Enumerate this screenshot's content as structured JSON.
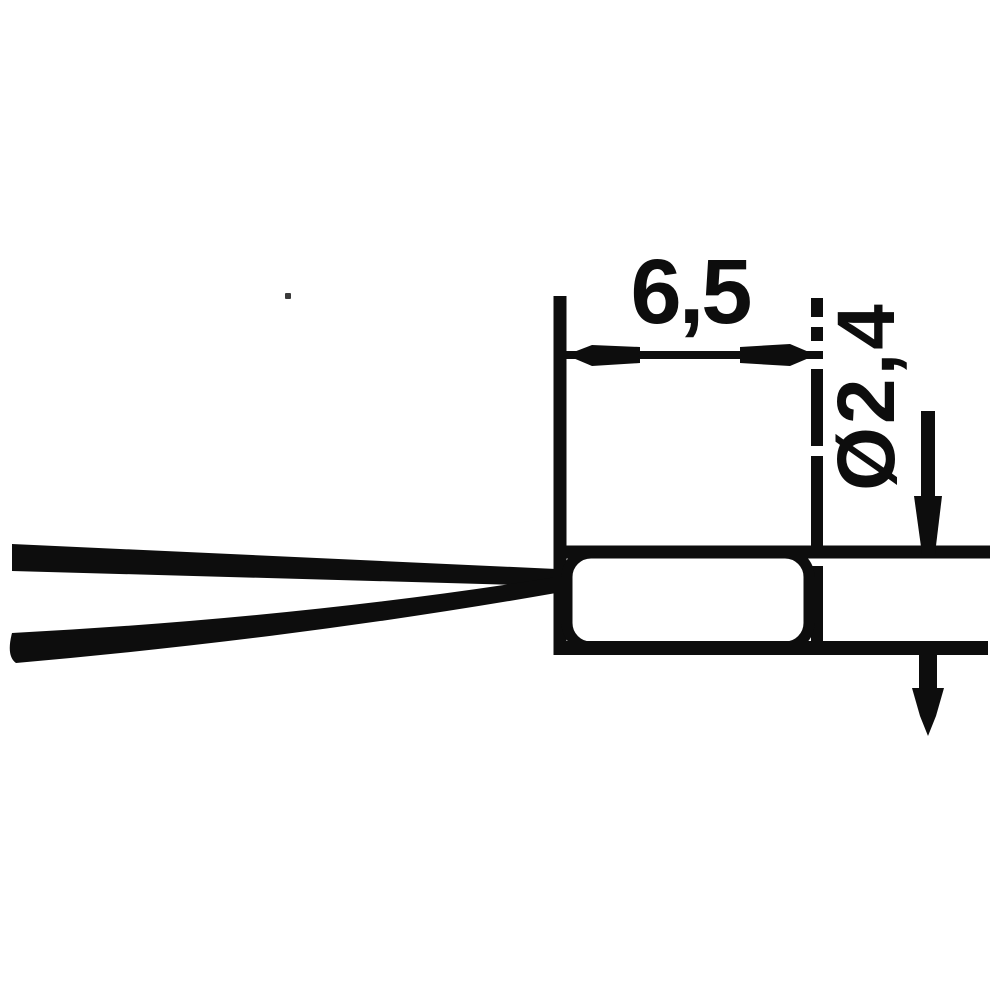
{
  "diagram": {
    "description_parts": [
      "lead-wire-upper",
      "lead-wire-lower",
      "bulb-body",
      "length-dimension",
      "diameter-dimension"
    ],
    "labels": {
      "length": "6,5",
      "diameter": "Ø2,4"
    },
    "colors": {
      "ink": "#0d0d0d",
      "background": "#ffffff"
    }
  }
}
